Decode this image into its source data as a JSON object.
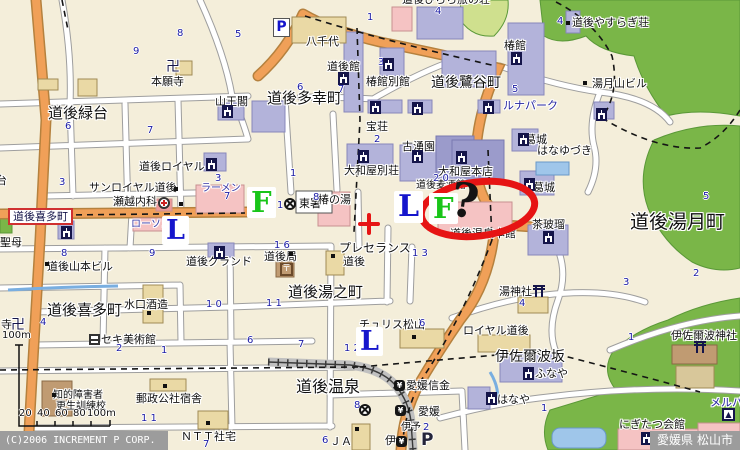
{
  "map": {
    "region_title": "道後温泉周辺",
    "footer": {
      "copyright": "(C)2006 INCREMENT P CORP.",
      "prefecture": "愛媛県",
      "city": "松山市"
    },
    "annotation": {
      "question_mark": "?",
      "circle_color": "#e61414",
      "crosshair_color": "#e61414"
    },
    "markers": [
      {
        "t": "L",
        "x": 162,
        "y": 216,
        "s": 27,
        "c": "#1515cc"
      },
      {
        "t": "L",
        "x": 394,
        "y": 191,
        "s": 30,
        "c": "#1515cc"
      },
      {
        "t": "L",
        "x": 356,
        "y": 327,
        "s": 27,
        "c": "#1515cc"
      },
      {
        "t": "F",
        "x": 247,
        "y": 187,
        "s": 29,
        "c": "#18c518"
      },
      {
        "t": "F",
        "x": 429,
        "y": 193,
        "s": 29,
        "c": "#18c518"
      },
      {
        "t": "?",
        "x": 451,
        "y": 178,
        "s": 47,
        "c": "#141414",
        "rot": 8,
        "nb": 1
      }
    ],
    "labels": [
      {
        "t": "道後緑台",
        "x": 48,
        "y": 106,
        "s": 15
      },
      {
        "t": "道後多幸町",
        "x": 267,
        "y": 91,
        "s": 15
      },
      {
        "t": "道後鷺谷町",
        "x": 431,
        "y": 76,
        "s": 14
      },
      {
        "t": "道後湯月町",
        "x": 630,
        "y": 213,
        "s": 19
      },
      {
        "t": "道後喜多町",
        "x": 47,
        "y": 303,
        "s": 15
      },
      {
        "t": "道後湯之町",
        "x": 288,
        "y": 285,
        "s": 15
      },
      {
        "t": "道後温泉",
        "x": 296,
        "y": 379,
        "s": 16
      },
      {
        "t": "伊佐爾波坂",
        "x": 495,
        "y": 350,
        "s": 14
      },
      {
        "t": "道後喜多町",
        "x": 8,
        "y": 208,
        "s": 11,
        "b": 1
      },
      {
        "t": "本願寺",
        "x": 151,
        "y": 76
      },
      {
        "t": "山王閣",
        "x": 215,
        "y": 96
      },
      {
        "t": "八千代",
        "x": 306,
        "y": 36
      },
      {
        "t": "道後館",
        "x": 327,
        "y": 61
      },
      {
        "t": "椿館別館",
        "x": 366,
        "y": 76
      },
      {
        "t": "道後やすらぎ荘",
        "x": 572,
        "y": 17
      },
      {
        "t": "道後ひらら旅の荘",
        "x": 402,
        "y": -6
      },
      {
        "t": "椿館",
        "x": 504,
        "y": 40
      },
      {
        "t": "ルナパーク",
        "x": 503,
        "y": 100,
        "c": "#2525a0"
      },
      {
        "t": "湯月山ビル",
        "x": 592,
        "y": 78
      },
      {
        "t": "宝荘",
        "x": 366,
        "y": 121
      },
      {
        "t": "古湧園",
        "x": 402,
        "y": 141
      },
      {
        "t": "大和屋別荘",
        "x": 344,
        "y": 165
      },
      {
        "t": "大和屋本店",
        "x": 438,
        "y": 166
      },
      {
        "t": "道後麦酒館",
        "x": 416,
        "y": 181,
        "s": 10
      },
      {
        "t": "道後ロイヤル",
        "x": 139,
        "y": 161
      },
      {
        "t": "サンロイヤル道後",
        "x": 89,
        "y": 182
      },
      {
        "t": "瀬越内科",
        "x": 113,
        "y": 196
      },
      {
        "t": "ローソン",
        "x": 131,
        "y": 220,
        "s": 10,
        "c": "#3535a5"
      },
      {
        "t": "ラーメン",
        "x": 201,
        "y": 184,
        "s": 10,
        "c": "#3535a5"
      },
      {
        "t": "東署",
        "x": 299,
        "y": 198
      },
      {
        "t": "椿の湯",
        "x": 318,
        "y": 194
      },
      {
        "t": "万石",
        "x": 402,
        "y": 209,
        "s": 10
      },
      {
        "t": "道後温泉本館",
        "x": 450,
        "y": 228
      },
      {
        "t": "茶玻瑠",
        "x": 532,
        "y": 219
      },
      {
        "t": "葛城",
        "x": 525,
        "y": 134
      },
      {
        "t": "はなゆづき",
        "x": 537,
        "y": 145
      },
      {
        "t": "葛城",
        "x": 533,
        "y": 182
      },
      {
        "t": "プレセランス",
        "x": 339,
        "y": 242,
        "s": 12
      },
      {
        "t": "道後",
        "x": 343,
        "y": 256
      },
      {
        "t": "道後局",
        "x": 264,
        "y": 251
      },
      {
        "t": "道後グランド",
        "x": 186,
        "y": 256
      },
      {
        "t": "道後山本ビル",
        "x": 47,
        "y": 261
      },
      {
        "t": "水口酒造",
        "x": 124,
        "y": 299
      },
      {
        "t": "セキ美術館",
        "x": 101,
        "y": 334
      },
      {
        "t": "知的障害者",
        "x": 53,
        "y": 391,
        "s": 10
      },
      {
        "t": "更生訓練校",
        "x": 56,
        "y": 402,
        "s": 10
      },
      {
        "t": "郵政公社宿舎",
        "x": 136,
        "y": 393
      },
      {
        "t": "ＮＴＴ社宅",
        "x": 181,
        "y": 431
      },
      {
        "t": "チュリス松山",
        "x": 359,
        "y": 319
      },
      {
        "t": "ロイヤル道後",
        "x": 463,
        "y": 325
      },
      {
        "t": "湯神社",
        "x": 499,
        "y": 286
      },
      {
        "t": "伊佐爾波神社",
        "x": 671,
        "y": 330
      },
      {
        "t": "ふなや",
        "x": 535,
        "y": 368
      },
      {
        "t": "はなや",
        "x": 497,
        "y": 394
      },
      {
        "t": "にぎたつ会館",
        "x": 619,
        "y": 419
      },
      {
        "t": "メルパ",
        "x": 710,
        "y": 397,
        "c": "#2525a0"
      },
      {
        "t": "愛媛信金",
        "x": 406,
        "y": 380
      },
      {
        "t": "愛媛",
        "x": 418,
        "y": 406
      },
      {
        "t": "伊予",
        "x": 401,
        "y": 423,
        "s": 10
      },
      {
        "t": "伊",
        "x": 385,
        "y": 435
      },
      {
        "t": "ＪＡ",
        "x": 330,
        "y": 436
      },
      {
        "t": "聖母",
        "x": 0,
        "y": 237
      },
      {
        "t": "寺",
        "x": 1,
        "y": 319
      },
      {
        "t": "台",
        "x": -4,
        "y": 175
      },
      {
        "t": "卍",
        "x": 166,
        "y": 60,
        "s": 14,
        "c": "#15154a"
      },
      {
        "t": "卍",
        "x": 11,
        "y": 318,
        "s": 14,
        "c": "#15154a"
      }
    ],
    "numbers": [
      {
        "t": "9",
        "x": 133,
        "y": 47
      },
      {
        "t": "8",
        "x": 177,
        "y": 29
      },
      {
        "t": "5",
        "x": 235,
        "y": 30
      },
      {
        "t": "1",
        "x": 367,
        "y": 13
      },
      {
        "t": "4",
        "x": 435,
        "y": 7
      },
      {
        "t": "4",
        "x": 557,
        "y": 17
      },
      {
        "t": "6",
        "x": 297,
        "y": 83
      },
      {
        "t": "7",
        "x": 338,
        "y": 85
      },
      {
        "t": "5",
        "x": 512,
        "y": 85
      },
      {
        "t": "3",
        "x": 378,
        "y": 58
      },
      {
        "t": "1",
        "x": 290,
        "y": 169
      },
      {
        "t": "2",
        "x": 374,
        "y": 135
      },
      {
        "t": "2 0",
        "x": 433,
        "y": 174
      },
      {
        "t": "6",
        "x": 65,
        "y": 122
      },
      {
        "t": "7",
        "x": 147,
        "y": 126
      },
      {
        "t": "3",
        "x": 59,
        "y": 178
      },
      {
        "t": "3",
        "x": 215,
        "y": 174
      },
      {
        "t": "7",
        "x": 224,
        "y": 192
      },
      {
        "t": "1 6",
        "x": 274,
        "y": 241
      },
      {
        "t": "1",
        "x": 277,
        "y": 201
      },
      {
        "t": "8",
        "x": 313,
        "y": 193
      },
      {
        "t": "1 3",
        "x": 412,
        "y": 249
      },
      {
        "t": "1 1",
        "x": 266,
        "y": 299
      },
      {
        "t": "1 2",
        "x": 344,
        "y": 344
      },
      {
        "t": "7",
        "x": 298,
        "y": 340
      },
      {
        "t": "6",
        "x": 247,
        "y": 336
      },
      {
        "t": "6",
        "x": 419,
        "y": 319
      },
      {
        "t": "4",
        "x": 40,
        "y": 318
      },
      {
        "t": "8",
        "x": 61,
        "y": 249
      },
      {
        "t": "9",
        "x": 149,
        "y": 249
      },
      {
        "t": "1 0",
        "x": 206,
        "y": 300
      },
      {
        "t": "2",
        "x": 116,
        "y": 344
      },
      {
        "t": "1",
        "x": 161,
        "y": 346
      },
      {
        "t": "4",
        "x": 519,
        "y": 299
      },
      {
        "t": "3",
        "x": 623,
        "y": 278
      },
      {
        "t": "2",
        "x": 693,
        "y": 269
      },
      {
        "t": "1",
        "x": 628,
        "y": 333
      },
      {
        "t": "5",
        "x": 703,
        "y": 192
      },
      {
        "t": "1 1",
        "x": 141,
        "y": 414
      },
      {
        "t": "7",
        "x": 203,
        "y": 440
      },
      {
        "t": "8",
        "x": 354,
        "y": 401
      },
      {
        "t": "2",
        "x": 423,
        "y": 423
      },
      {
        "t": "1",
        "x": 541,
        "y": 404
      },
      {
        "t": "6",
        "x": 322,
        "y": 436
      },
      {
        "t": "20",
        "x": 19,
        "y": 409,
        "c": "#111"
      },
      {
        "t": "40",
        "x": 37,
        "y": 409,
        "c": "#111"
      },
      {
        "t": "60",
        "x": 55,
        "y": 409,
        "c": "#111"
      },
      {
        "t": "80",
        "x": 73,
        "y": 409,
        "c": "#111"
      },
      {
        "t": "100m",
        "x": 87,
        "y": 409,
        "c": "#111"
      },
      {
        "t": "100m",
        "x": 2,
        "y": 331,
        "c": "#111"
      }
    ],
    "icons": [
      {
        "k": "hotel",
        "x": 222,
        "y": 105
      },
      {
        "k": "hotel",
        "x": 338,
        "y": 72
      },
      {
        "k": "hotel",
        "x": 383,
        "y": 58
      },
      {
        "k": "hotel",
        "x": 370,
        "y": 101
      },
      {
        "k": "hotel",
        "x": 412,
        "y": 102
      },
      {
        "k": "hotel",
        "x": 483,
        "y": 101
      },
      {
        "k": "hotel",
        "x": 511,
        "y": 52
      },
      {
        "k": "hotel",
        "x": 358,
        "y": 150
      },
      {
        "k": "hotel",
        "x": 412,
        "y": 150
      },
      {
        "k": "hotel",
        "x": 456,
        "y": 151
      },
      {
        "k": "hotel",
        "x": 518,
        "y": 133
      },
      {
        "k": "hotel",
        "x": 524,
        "y": 178
      },
      {
        "k": "hotel",
        "x": 543,
        "y": 231
      },
      {
        "k": "hotel",
        "x": 206,
        "y": 158
      },
      {
        "k": "hotel",
        "x": 61,
        "y": 226
      },
      {
        "k": "hotel",
        "x": 214,
        "y": 246
      },
      {
        "k": "hotel",
        "x": 596,
        "y": 108
      },
      {
        "k": "hotel",
        "x": 523,
        "y": 367
      },
      {
        "k": "hotel",
        "x": 486,
        "y": 392
      },
      {
        "k": "hotel",
        "x": 641,
        "y": 432
      },
      {
        "k": "torii",
        "x": 533,
        "y": 285
      },
      {
        "k": "torii",
        "x": 694,
        "y": 341
      },
      {
        "k": "police",
        "x": 284,
        "y": 198
      },
      {
        "k": "police",
        "x": 359,
        "y": 404
      },
      {
        "k": "hospital",
        "x": 158,
        "y": 197
      },
      {
        "k": "post",
        "x": 280,
        "y": 263,
        "g": "〒"
      },
      {
        "k": "bank",
        "x": 394,
        "y": 380,
        "g": "¥"
      },
      {
        "k": "bank",
        "x": 395,
        "y": 405,
        "g": "¥"
      },
      {
        "k": "bank",
        "x": 396,
        "y": 436,
        "g": "¥"
      },
      {
        "k": "museum",
        "x": 89,
        "y": 334
      },
      {
        "k": "parkp",
        "x": 273,
        "y": 18,
        "g": "P"
      },
      {
        "k": "parkp2",
        "x": 421,
        "y": 432,
        "g": "P"
      },
      {
        "k": "bldgtri",
        "x": 722,
        "y": 408,
        "g": "▲"
      },
      {
        "k": "dot",
        "x": 566,
        "y": 21
      },
      {
        "k": "dot",
        "x": 583,
        "y": 81
      },
      {
        "k": "dot",
        "x": 174,
        "y": 187
      },
      {
        "k": "dot",
        "x": 179,
        "y": 202
      },
      {
        "k": "dot",
        "x": 45,
        "y": 262
      },
      {
        "k": "dot",
        "x": 147,
        "y": 311
      },
      {
        "k": "dot",
        "x": 52,
        "y": 393
      },
      {
        "k": "dot",
        "x": 163,
        "y": 384
      },
      {
        "k": "dot",
        "x": 206,
        "y": 421
      },
      {
        "k": "dot",
        "x": 412,
        "y": 335
      },
      {
        "k": "dot",
        "x": 331,
        "y": 254
      },
      {
        "k": "dot",
        "x": 355,
        "y": 427
      },
      {
        "k": "dot",
        "x": 289,
        "y": 252
      }
    ]
  }
}
